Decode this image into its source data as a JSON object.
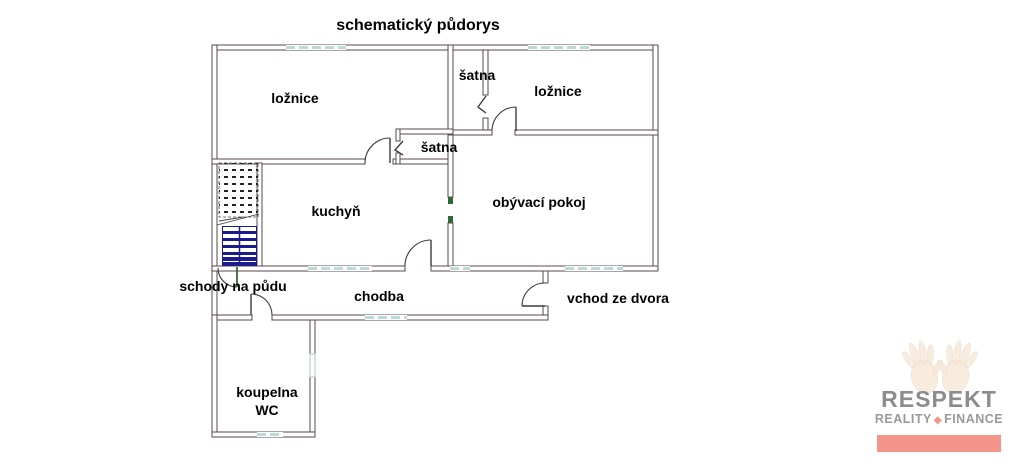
{
  "title": "schematický půdorys",
  "rooms": [
    {
      "id": "loznice-left",
      "label": "ložnice"
    },
    {
      "id": "satna-top",
      "label": "šatna"
    },
    {
      "id": "loznice-right",
      "label": "ložnice"
    },
    {
      "id": "satna-lower",
      "label": "šatna"
    },
    {
      "id": "kuchyn",
      "label": "kuchyň"
    },
    {
      "id": "obyvaci-pokoj",
      "label": "obývací pokoj"
    },
    {
      "id": "schody-na-pudu",
      "label": "schody na půdu"
    },
    {
      "id": "chodba",
      "label": "chodba"
    },
    {
      "id": "vchod-ze-dvora",
      "label": "vchod ze dvora"
    },
    {
      "id": "koupelna-wc",
      "label": "koupelna",
      "label2": "WC"
    }
  ],
  "logo": {
    "brand": "RESPEKT",
    "tagline_left": "REALITY",
    "separator": "◆",
    "tagline_right": "FINANCE"
  },
  "colors": {
    "wall": "#5a474e",
    "window": "#b9dad8",
    "stair_tread": "#1b1b8a",
    "door": "#3c3c3c",
    "door_jamb": "#2e6b34",
    "label_text": "#000000",
    "logo_text": "#8c8c8c",
    "logo_tagline": "#9a9a9a",
    "logo_bar": "#f4958b",
    "hands": "#f6e7d7"
  }
}
